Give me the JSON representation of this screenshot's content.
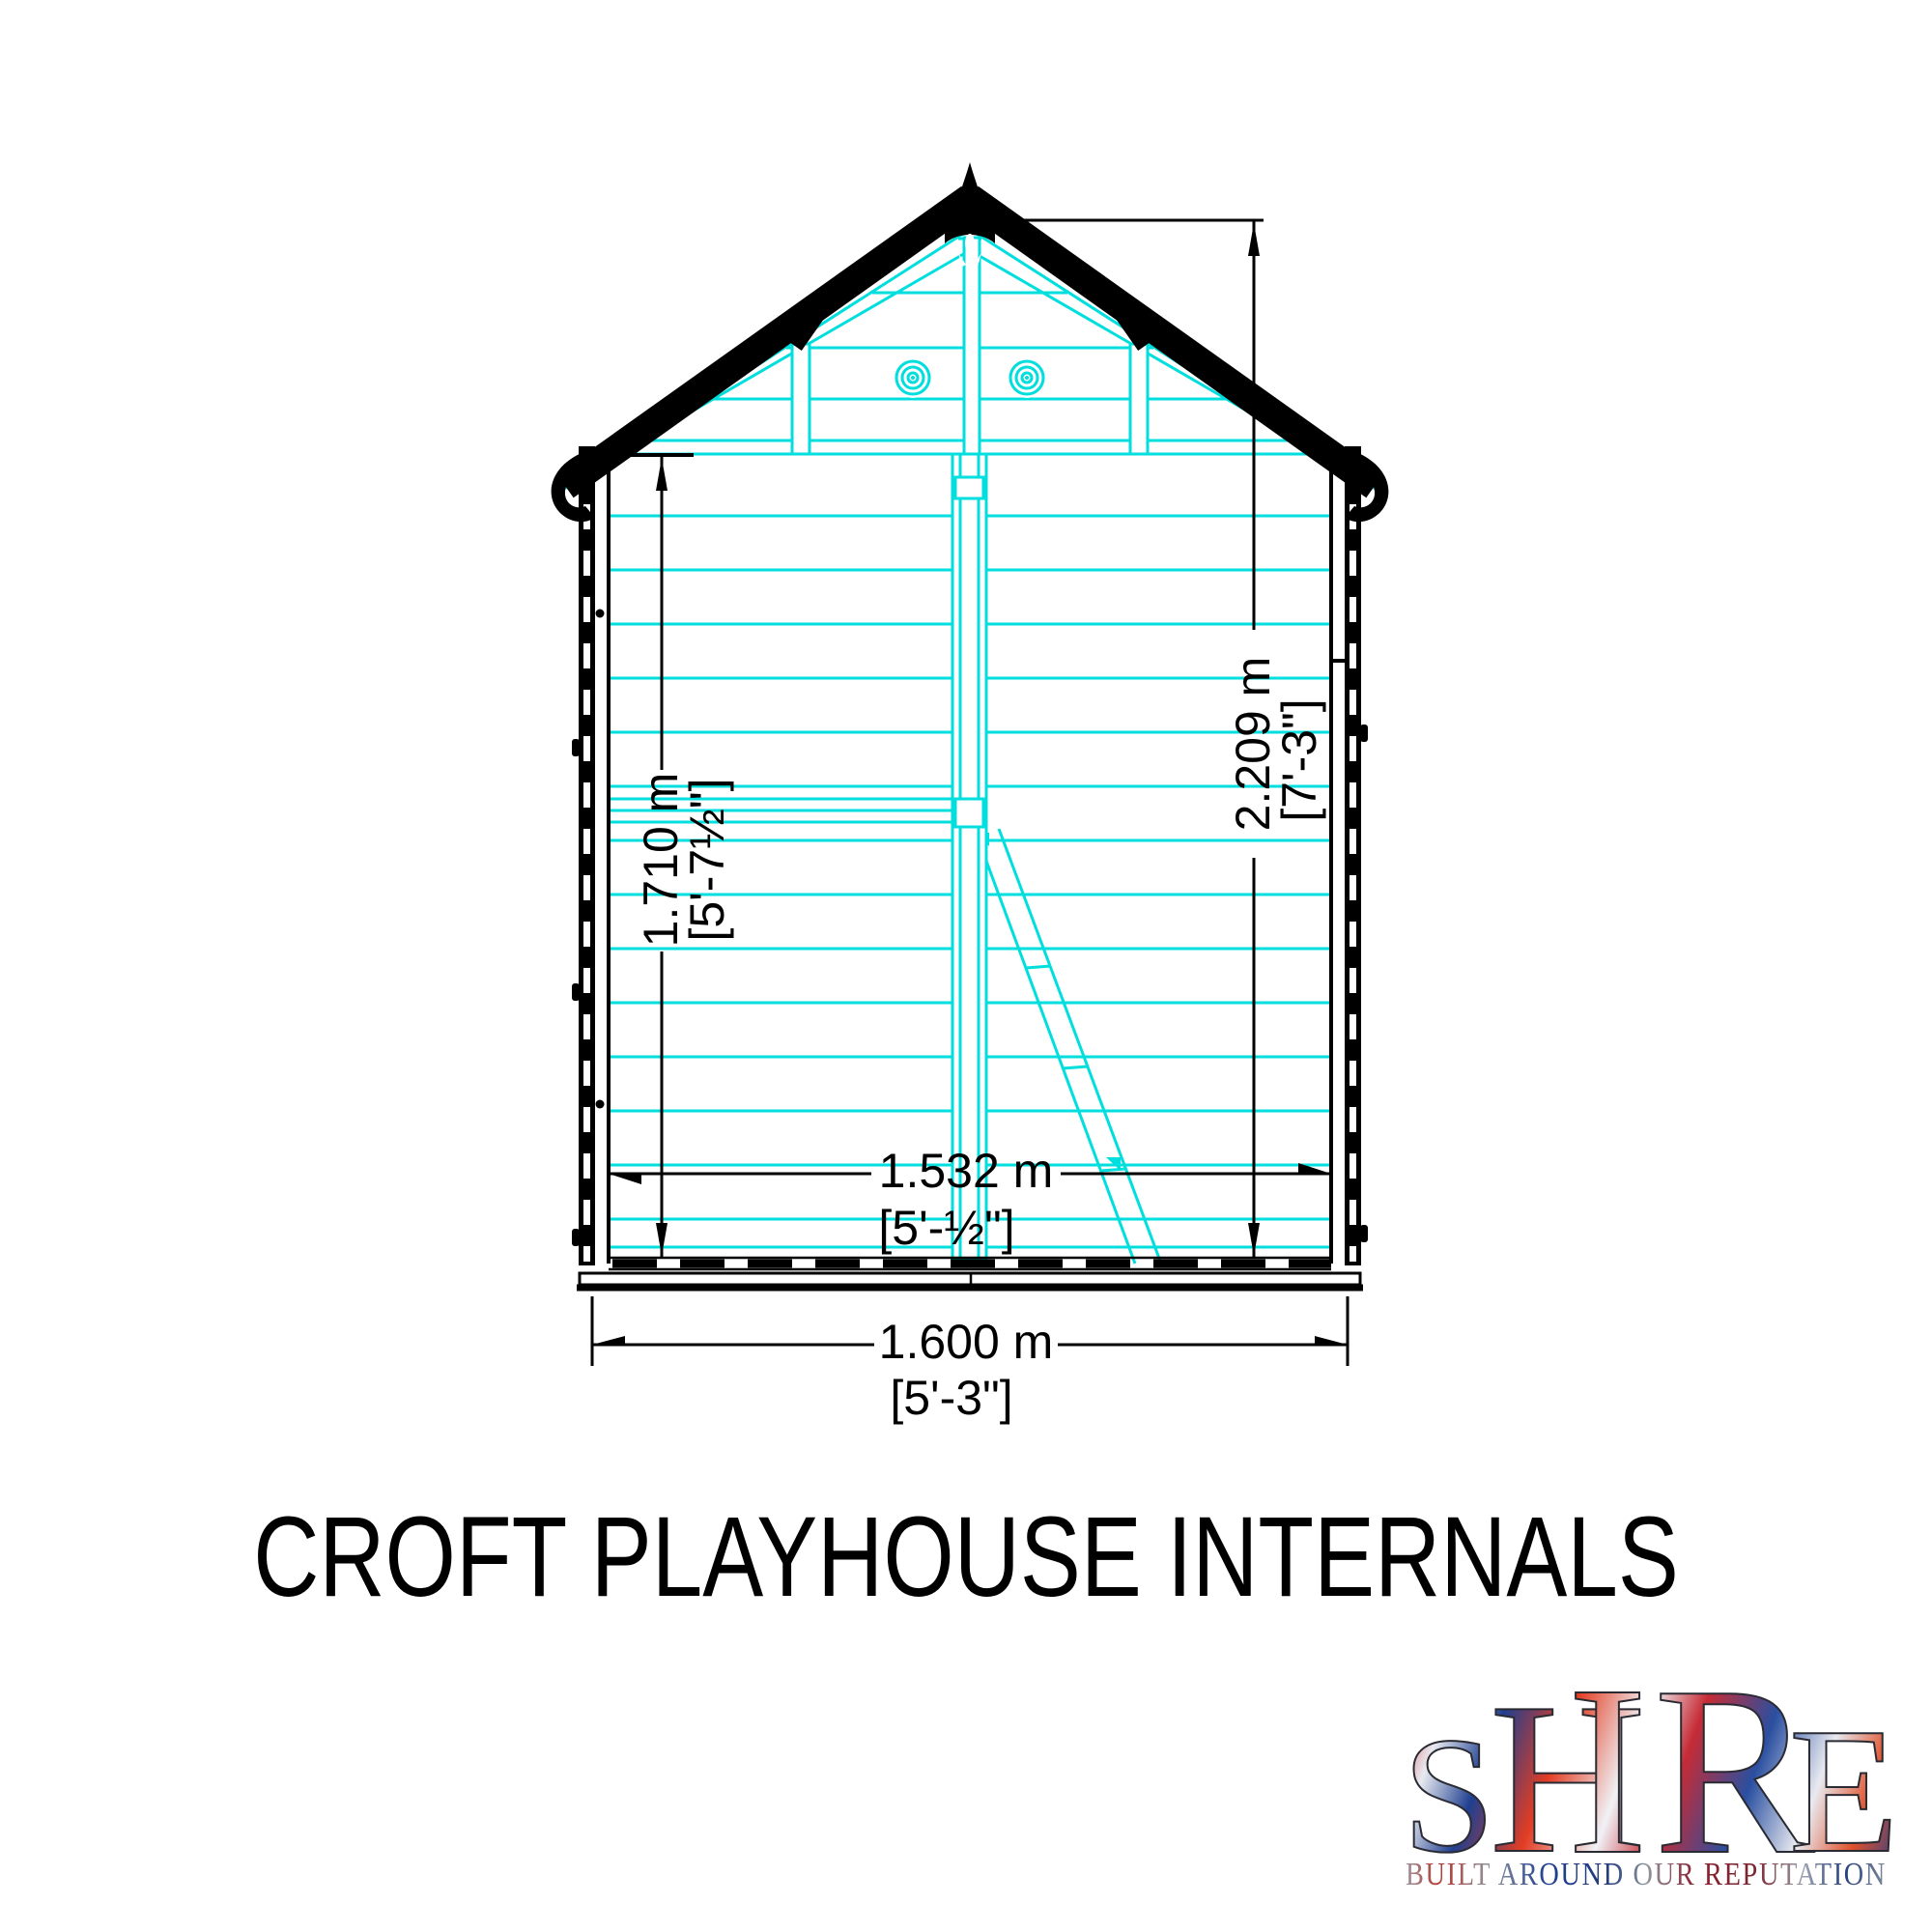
{
  "title": "CROFT PLAYHOUSE INTERNALS",
  "drawing": {
    "description": "Croft playhouse internal cross-section technical drawing",
    "colors": {
      "outline": "#000000",
      "framing_lines": "#00dede",
      "background": "#ffffff"
    },
    "dimensions": {
      "eaves_height": {
        "metric": "1.710 m",
        "imperial": "[5'-7½\"]"
      },
      "ridge_height": {
        "metric": "2.209 m",
        "imperial": "[7'-3\"]"
      },
      "internal_width": {
        "metric": "1.532 m",
        "imperial": "[5'-½\"]"
      },
      "external_width": {
        "metric": "1.600 m",
        "imperial": "[5'-3\"]"
      }
    }
  },
  "logo": {
    "word": "SHIRE",
    "letters": [
      "S",
      "H",
      "I",
      "R",
      "E"
    ],
    "tagline": "BUILT AROUND OUR REPUTATION",
    "palette": {
      "red": "#cf2b28",
      "blue": "#1f3f8f",
      "silver": "#c3c9d4"
    }
  }
}
